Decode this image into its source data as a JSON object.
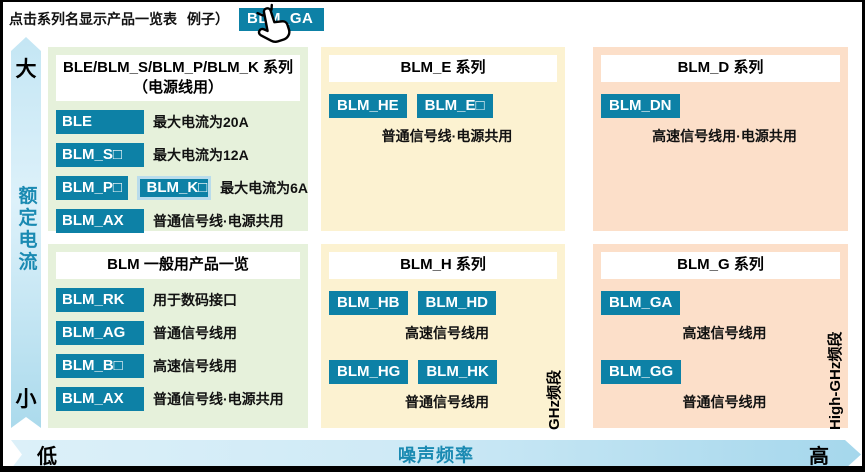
{
  "header": {
    "instruction": "点击系列名显示产品一览表",
    "example_prefix": "例子）",
    "example_button": "BLM_GA"
  },
  "axes": {
    "y": {
      "max_label": "大",
      "axis_label": "额定电流",
      "min_label": "小"
    },
    "x": {
      "min_label": "低",
      "axis_label": "噪声频率",
      "max_label": "高"
    }
  },
  "band_labels": {
    "ghz": "GHz频段",
    "high_ghz": "High-GHz频段"
  },
  "colors": {
    "accent_teal": "#0d81a6",
    "panel_green": "#e6f1db",
    "panel_yellow": "#fcf2d1",
    "panel_pink": "#fcdfc9",
    "axis_text_teal": "#1a8ab2",
    "arrow_blue_light": "#dcf0f9",
    "arrow_blue_dark": "#a5d7ec"
  },
  "panels": {
    "power": {
      "title": "BLE/BLM_S/BLM_P/BLM_K 系列",
      "subtitle": "（电源线用）",
      "rows": [
        {
          "b1": "BLE",
          "desc": "最大电流为20A"
        },
        {
          "b1": "BLM_S□",
          "desc": "最大电流为12A"
        },
        {
          "b1": "BLM_P□",
          "b2": "BLM_K□",
          "desc": "最大电流为6A"
        },
        {
          "b1": "BLM_AX",
          "desc": "普通信号线·电源共用"
        }
      ]
    },
    "general": {
      "title": "BLM 一般用产品一览",
      "rows": [
        {
          "b1": "BLM_RK",
          "desc": "用于数码接口"
        },
        {
          "b1": "BLM_AG",
          "desc": "普通信号线用"
        },
        {
          "b1": "BLM_B□",
          "desc": "高速信号线用"
        },
        {
          "b1": "BLM_AX",
          "desc": "普通信号线·电源共用"
        }
      ]
    },
    "e": {
      "title": "BLM_E 系列",
      "groups": [
        {
          "b1": "BLM_HE",
          "b2": "BLM_E□",
          "caption": "普通信号线·电源共用"
        }
      ]
    },
    "h": {
      "title": "BLM_H 系列",
      "groups": [
        {
          "b1": "BLM_HB",
          "b2": "BLM_HD",
          "caption": "高速信号线用"
        },
        {
          "b1": "BLM_HG",
          "b2": "BLM_HK",
          "caption": "普通信号线用"
        }
      ]
    },
    "d": {
      "title": "BLM_D 系列",
      "groups": [
        {
          "b1": "BLM_DN",
          "caption": "高速信号线用·电源共用"
        }
      ]
    },
    "g": {
      "title": "BLM_G 系列",
      "groups": [
        {
          "b1": "BLM_GA",
          "caption": "高速信号线用"
        },
        {
          "b1": "BLM_GG",
          "caption": "普通信号线用"
        }
      ]
    }
  }
}
